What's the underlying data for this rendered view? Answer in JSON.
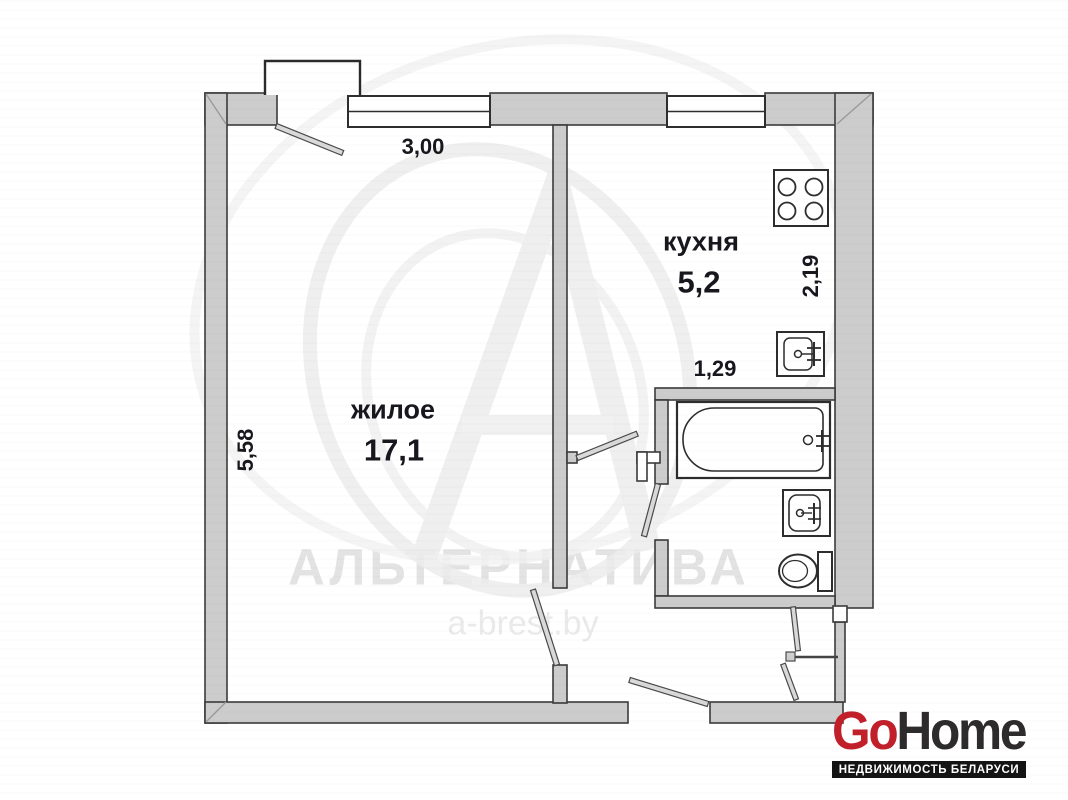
{
  "floor_plan": {
    "rooms": [
      {
        "name": "жилое",
        "area": "17,1"
      },
      {
        "name": "кухня",
        "area": "5,2"
      }
    ],
    "dimensions": {
      "top_width": "3,00",
      "left_height": "5,58",
      "kitchen_depth": "2,19",
      "hall_width": "1,29"
    },
    "fixtures": [
      "stove",
      "kitchen-sink",
      "bathtub",
      "washbasin",
      "toilet"
    ]
  },
  "watermark": {
    "title": "АЛЬТЕРНАТИВА",
    "website": "a-brest.by"
  },
  "logo": {
    "brand_red": "Go",
    "brand_dark": "Home",
    "tagline": "НЕДВИЖИМОСТЬ БЕЛАРУСИ"
  },
  "colors": {
    "wall_fill": "#cccccc",
    "wall_outline": "#3b3b3b",
    "label_text": "#17171d",
    "watermark_gray": "#e3e3e3",
    "logo_red": "#c1202a",
    "logo_dark": "#2d2b2b",
    "logo_bar_bg": "#141414"
  }
}
